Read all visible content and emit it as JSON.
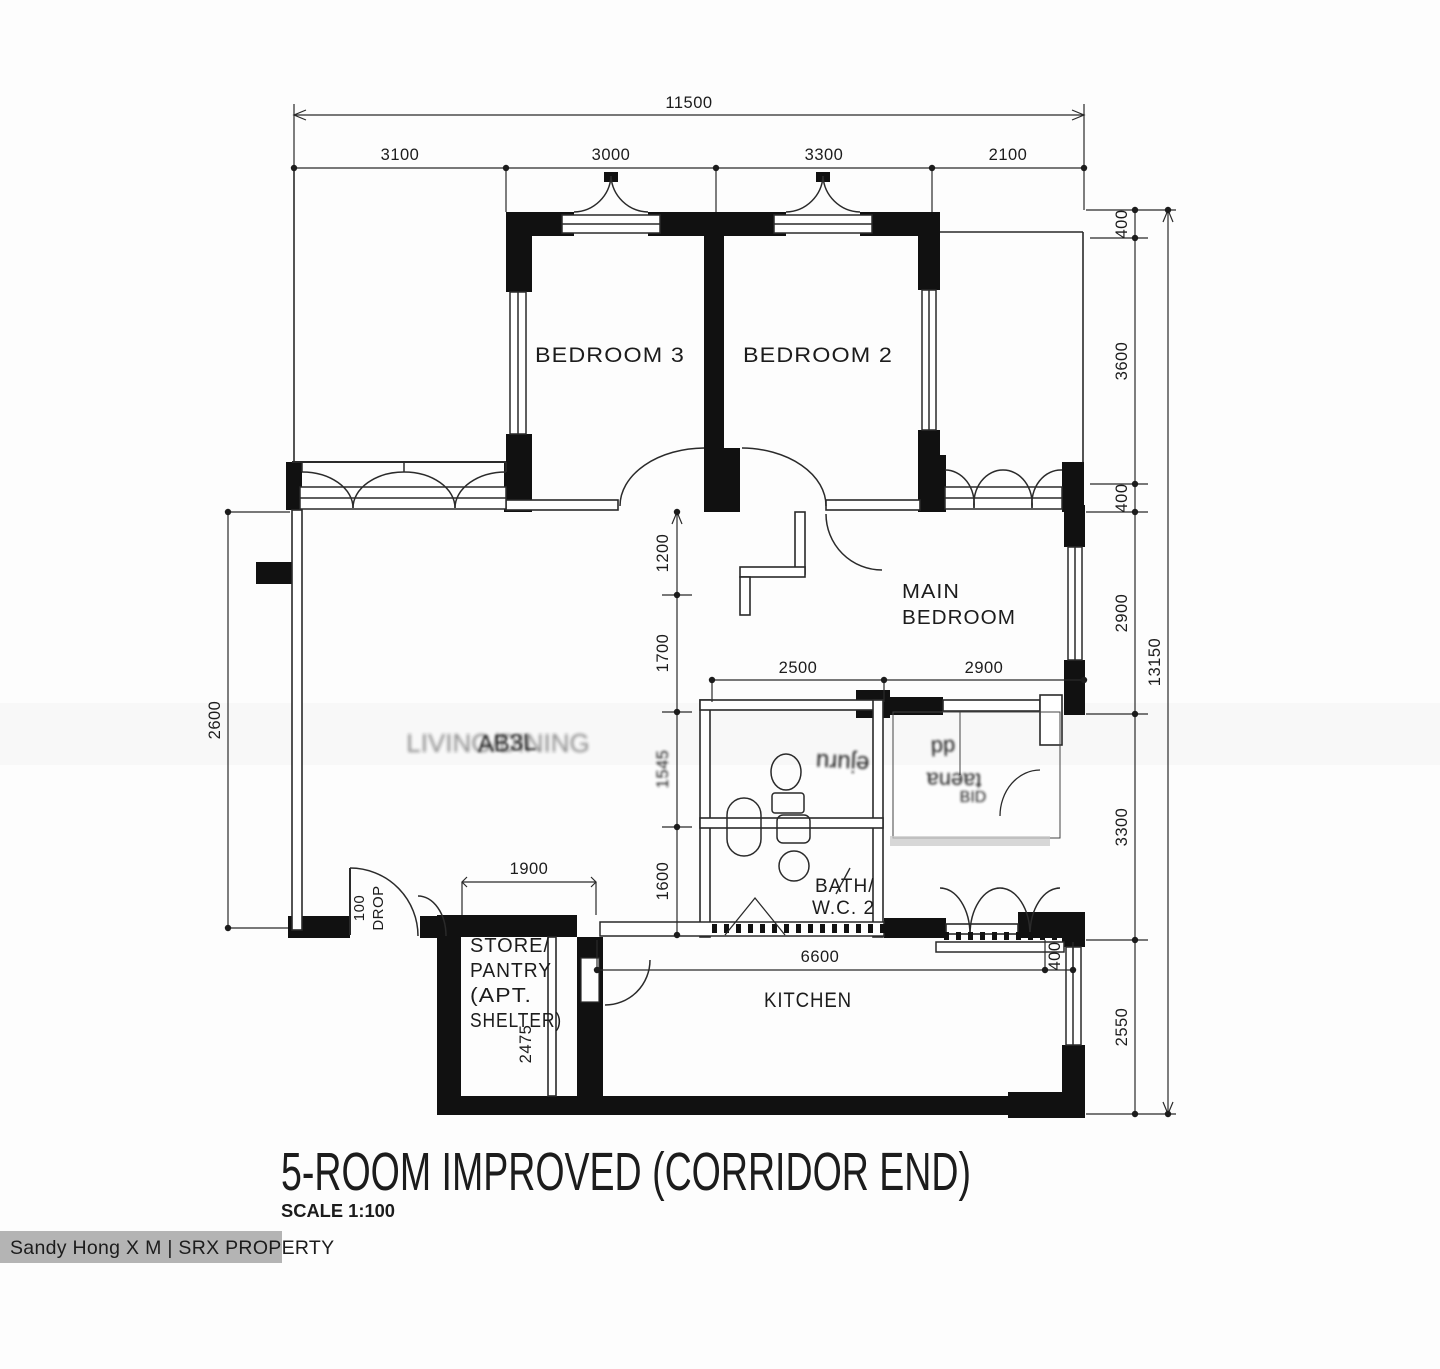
{
  "title": {
    "main": "5-ROOM IMPROVED (CORRIDOR END)",
    "scale": "SCALE 1:100"
  },
  "watermark": {
    "text": "Sandy Hong X M | SRX PROPERTY"
  },
  "rooms": {
    "bedroom3": "BEDROOM 3",
    "bedroom2": "BEDROOM 2",
    "main_bedroom": {
      "line1": "MAIN",
      "line2": "BEDROOM"
    },
    "bath_wc2": {
      "line1": "BATH/",
      "line2": "W.C. 2"
    },
    "kitchen": "KITCHEN",
    "store": {
      "line1": "STORE/",
      "line2": "PANTRY",
      "line3": "(APT.",
      "line4": "SHELTER)"
    },
    "living_smudge": "AB3L",
    "living_ghost": "LIVING/DINING",
    "garbled": {
      "bath1": "ejuru",
      "side1": "dd",
      "side2": "taena",
      "side3": "BID"
    }
  },
  "dimensions": {
    "overall_width": "11500",
    "width_segments": [
      "3100",
      "3000",
      "3300",
      "2100"
    ],
    "overall_height": "13150",
    "height_segments": [
      "400",
      "3600",
      "400",
      "2900",
      "3300",
      "2550"
    ],
    "left_height": "2600",
    "inner_heights": [
      "1200",
      "1700",
      "1545",
      "1600"
    ],
    "bedroom_widths": [
      "2500",
      "2900"
    ],
    "store_width": "1900",
    "store_depth": "2475",
    "kitchen_width": "6600",
    "kitchen_recess": "400",
    "entrance_note1": "100",
    "entrance_note2": "DROP"
  }
}
